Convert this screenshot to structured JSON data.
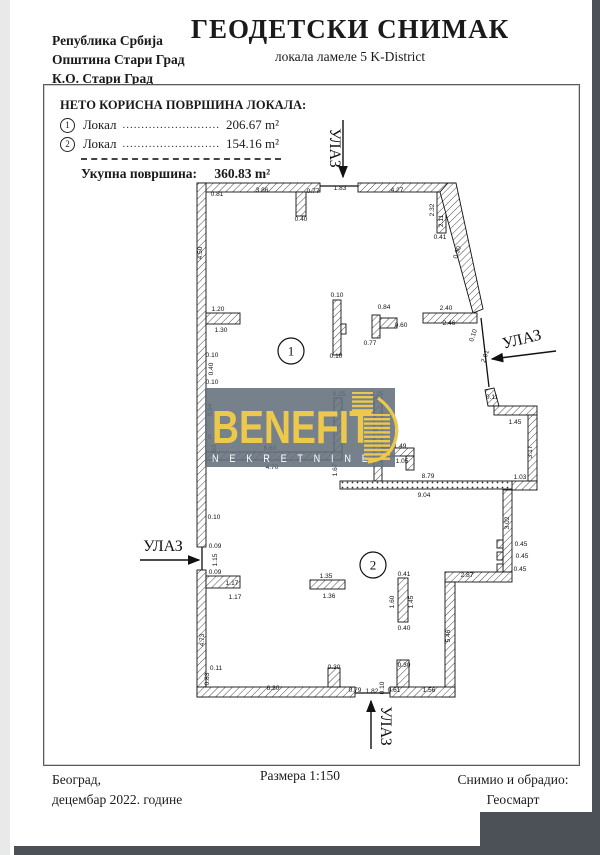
{
  "header": {
    "region_lines": [
      "Република Србија",
      "Општина Стари Град",
      "К.О. Стари Град"
    ],
    "title": "ГЕОДЕТСКИ СНИМАК",
    "subtitle": "локала ламеле 5 K-District"
  },
  "info_box": {
    "heading": "НЕТО КОРИСНА ПОВРШИНА ЛОКАЛА:",
    "rows": [
      {
        "num": "1",
        "label": "Локал",
        "dots": "..........................",
        "value": "206.67 m²"
      },
      {
        "num": "2",
        "label": "Локал",
        "dots": "..........................",
        "value": "154.16 m²"
      }
    ],
    "total_label": "Укупна површина:",
    "total_value": "360.83 m²"
  },
  "footer": {
    "place_line1": "Београд,",
    "place_line2": "децембар 2022. године",
    "scale": "Размера 1:150",
    "surveyor_line1": "Снимио и обрадио:",
    "surveyor_line2": "Геосмарт"
  },
  "logo": {
    "name": "BENEFIT",
    "sub": "N E K R E T N I N E",
    "gold": "#ECC84D",
    "bg": "#64707C"
  },
  "plan": {
    "areas": [
      {
        "num": "1",
        "x": 291,
        "y": 351
      },
      {
        "num": "2",
        "x": 373,
        "y": 565
      }
    ],
    "entrances": [
      {
        "label": "УЛАЗ",
        "tx": 330,
        "ty": 148,
        "rot": 90,
        "ax1": 343,
        "ay1": 120,
        "ax2": 343,
        "ay2": 177
      },
      {
        "label": "УЛАЗ",
        "tx": 523,
        "ty": 344,
        "rot": -14,
        "ax1": 556,
        "ay1": 351,
        "ax2": 492,
        "ay2": 359
      },
      {
        "label": "УЛАЗ",
        "tx": 163,
        "ty": 551,
        "rot": 0,
        "ax1": 140,
        "ay1": 560,
        "ax2": 199,
        "ay2": 560
      },
      {
        "label": "УЛАЗ",
        "tx": 381,
        "ty": 726,
        "rot": 90,
        "ax1": 371,
        "ay1": 749,
        "ax2": 371,
        "ay2": 701
      }
    ],
    "dimensions": [
      {
        "t": "0.81",
        "x": 217,
        "y": 196
      },
      {
        "t": "3.86",
        "x": 262,
        "y": 192
      },
      {
        "t": "0.77",
        "x": 313,
        "y": 193
      },
      {
        "t": "1.83",
        "x": 340,
        "y": 190
      },
      {
        "t": "4.27",
        "x": 397,
        "y": 192
      },
      {
        "t": "0.40",
        "x": 301,
        "y": 221
      },
      {
        "t": "2.32",
        "x": 434,
        "y": 210,
        "r": -90
      },
      {
        "t": "2.11",
        "x": 443,
        "y": 221,
        "r": -90
      },
      {
        "t": "0.41",
        "x": 440,
        "y": 239
      },
      {
        "t": "0.30",
        "x": 459,
        "y": 253,
        "r": -72
      },
      {
        "t": "4.50",
        "x": 202,
        "y": 253,
        "r": -90
      },
      {
        "t": "1.20",
        "x": 218,
        "y": 311
      },
      {
        "t": "1.30",
        "x": 221,
        "y": 332
      },
      {
        "t": "0.10",
        "x": 212,
        "y": 357
      },
      {
        "t": "0.40",
        "x": 213,
        "y": 369,
        "r": -90
      },
      {
        "t": "0.10",
        "x": 212,
        "y": 384
      },
      {
        "t": "0.10",
        "x": 337,
        "y": 297
      },
      {
        "t": "0.10",
        "x": 336,
        "y": 358
      },
      {
        "t": "0.84",
        "x": 384,
        "y": 309
      },
      {
        "t": "0.60",
        "x": 401,
        "y": 327
      },
      {
        "t": "0.77",
        "x": 370,
        "y": 345
      },
      {
        "t": "2.40",
        "x": 446,
        "y": 310
      },
      {
        "t": "2.46",
        "x": 449,
        "y": 325
      },
      {
        "t": "0.10",
        "x": 475,
        "y": 336,
        "r": -72
      },
      {
        "t": "2.01",
        "x": 487,
        "y": 357,
        "r": -72
      },
      {
        "t": "0.11",
        "x": 492,
        "y": 399
      },
      {
        "t": "1.45",
        "x": 515,
        "y": 424
      },
      {
        "t": "3.17",
        "x": 532,
        "y": 452,
        "r": -90
      },
      {
        "t": "1.03",
        "x": 520,
        "y": 479
      },
      {
        "t": "3.02",
        "x": 509,
        "y": 523,
        "r": -90
      },
      {
        "t": "0.45",
        "x": 521,
        "y": 546
      },
      {
        "t": "0.45",
        "x": 522,
        "y": 558
      },
      {
        "t": "0.45",
        "x": 520,
        "y": 571
      },
      {
        "t": "2.87",
        "x": 467,
        "y": 577
      },
      {
        "t": "5.46",
        "x": 450,
        "y": 636,
        "r": -90
      },
      {
        "t": "0.25",
        "x": 339,
        "y": 396
      },
      {
        "t": "0.25",
        "x": 377,
        "y": 396
      },
      {
        "t": "1.87",
        "x": 378,
        "y": 432,
        "r": -90
      },
      {
        "t": "0.94",
        "x": 212,
        "y": 410,
        "r": -90
      },
      {
        "t": "0.10",
        "x": 214,
        "y": 439
      },
      {
        "t": "1.63",
        "x": 216,
        "y": 451,
        "r": -90
      },
      {
        "t": "6.63",
        "x": 270,
        "y": 450
      },
      {
        "t": "4.70",
        "x": 272,
        "y": 469
      },
      {
        "t": "1.67",
        "x": 337,
        "y": 470,
        "r": -90
      },
      {
        "t": "1.49",
        "x": 400,
        "y": 448
      },
      {
        "t": "1.05",
        "x": 402,
        "y": 463
      },
      {
        "t": "8.79",
        "x": 428,
        "y": 478
      },
      {
        "t": "9.04",
        "x": 424,
        "y": 497
      },
      {
        "t": "0.10",
        "x": 214,
        "y": 519
      },
      {
        "t": "0.09",
        "x": 215,
        "y": 548
      },
      {
        "t": "1.15",
        "x": 217,
        "y": 560,
        "r": -90
      },
      {
        "t": "0.09",
        "x": 215,
        "y": 574
      },
      {
        "t": "1.17",
        "x": 232,
        "y": 585
      },
      {
        "t": "1.17",
        "x": 235,
        "y": 599
      },
      {
        "t": "1.35",
        "x": 326,
        "y": 578
      },
      {
        "t": "1.36",
        "x": 329,
        "y": 598
      },
      {
        "t": "0.41",
        "x": 404,
        "y": 576
      },
      {
        "t": "1.60",
        "x": 394,
        "y": 602,
        "r": -90
      },
      {
        "t": "1.45",
        "x": 413,
        "y": 602,
        "r": -90
      },
      {
        "t": "0.40",
        "x": 404,
        "y": 630
      },
      {
        "t": "4.73",
        "x": 204,
        "y": 640,
        "r": -90
      },
      {
        "t": "0.11",
        "x": 216,
        "y": 670
      },
      {
        "t": "0.83",
        "x": 209,
        "y": 679,
        "r": -90
      },
      {
        "t": "6.30",
        "x": 273,
        "y": 690
      },
      {
        "t": "0.30",
        "x": 334,
        "y": 669
      },
      {
        "t": "0.79",
        "x": 355,
        "y": 692
      },
      {
        "t": "1.82",
        "x": 372,
        "y": 693
      },
      {
        "t": "0.10",
        "x": 384,
        "y": 688,
        "r": -90
      },
      {
        "t": "0.61",
        "x": 394,
        "y": 692
      },
      {
        "t": "0.30",
        "x": 404,
        "y": 667
      },
      {
        "t": "1.56",
        "x": 429,
        "y": 692
      }
    ]
  }
}
